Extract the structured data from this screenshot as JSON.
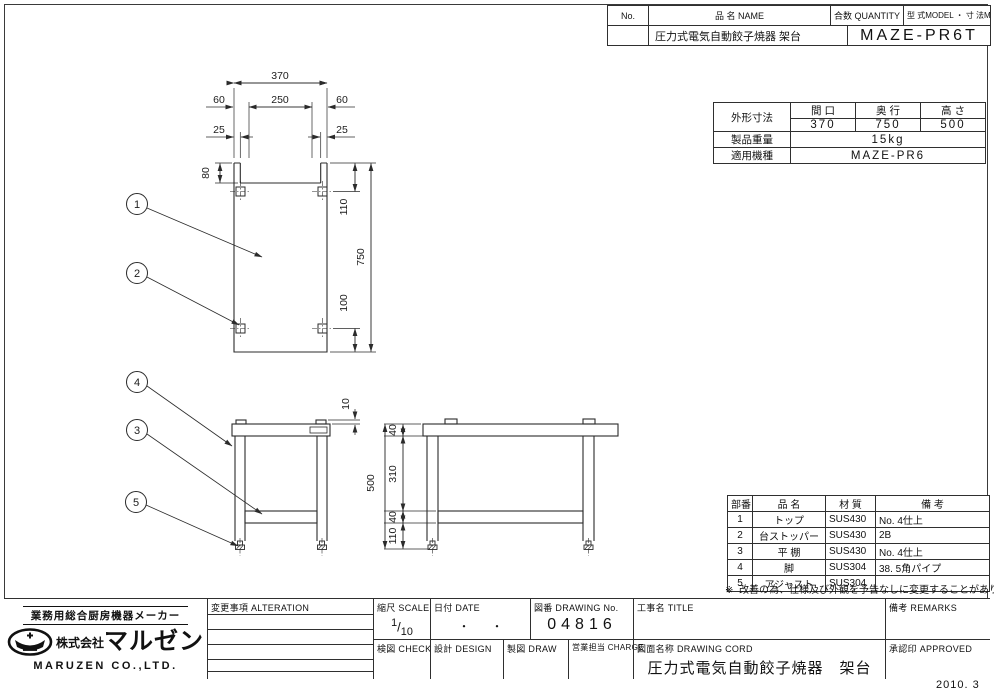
{
  "header_table": {
    "col_no": "No.",
    "col_name": "品  名 NAME",
    "col_qty": "合数 QUANTITY",
    "col_model": "型 式MODEL ・ 寸 法MEASUR",
    "name_value": "圧力式電気自動餃子焼器  架台",
    "model_value": "MAZE-PR6T"
  },
  "spec_table": {
    "dim_label": "外形寸法",
    "col_width": "間 口",
    "col_depth": "奥 行",
    "col_height": "高 さ",
    "width": "370",
    "depth": "750",
    "height": "500",
    "weight_label": "製品重量",
    "weight": "15kg",
    "model_label": "適用機種",
    "model": "MAZE-PR6"
  },
  "parts_table": {
    "col_no": "部番",
    "col_name": "品  名",
    "col_material": "材 質",
    "col_remarks": "備  考",
    "rows": [
      {
        "no": "1",
        "name": "トップ",
        "material": "SUS430",
        "remarks": "No. 4仕上"
      },
      {
        "no": "2",
        "name": "台ストッパー",
        "material": "SUS430",
        "remarks": "2B"
      },
      {
        "no": "3",
        "name": "平 棚",
        "material": "SUS430",
        "remarks": "No. 4仕上"
      },
      {
        "no": "4",
        "name": "脚",
        "material": "SUS304",
        "remarks": "38. 5角パイプ"
      },
      {
        "no": "5",
        "name": "アジャスト",
        "material": "SUS304",
        "remarks": ""
      }
    ]
  },
  "note": {
    "mark": "※",
    "text": "改善の為、仕様及び外観を予告なしに変更することがあります。"
  },
  "title_block": {
    "alteration_label": "変更事項 ALTERATION",
    "scale_label": "縮尺 SCALE",
    "scale_num": "1",
    "scale_slash": "/",
    "scale_den": "10",
    "date_label": "日付 DATE",
    "date_value": "・　　・",
    "dwg_no_label": "図番 DRAWING  No.",
    "dwg_no": "04816",
    "title_label": "工事名 TITLE",
    "remarks_label": "備考 REMARKS",
    "check_label": "検図 CHECK",
    "design_label": "設計 DESIGN",
    "draw_label": "製図 DRAW",
    "charge_label": "営業担当 CHARGE",
    "cord_label": "図面名称 DRAWING  CORD",
    "cord_value": "圧力式電気自動餃子焼器　架台",
    "approved_label": "承認印 APPROVED"
  },
  "company": {
    "tagline": "業務用総合厨房機器メーカー",
    "prefix": "株式会社",
    "brand": "マルゼン",
    "name_en": "MARUZEN  CO.,LTD."
  },
  "footer": {
    "date": "2010. 3"
  },
  "drawing": {
    "dims": {
      "overall_width": "370",
      "inner": "250",
      "offset_left": "60",
      "offset_right": "60",
      "tab_left": "25",
      "tab_right": "25",
      "step": "80",
      "top_to_stopper": "110",
      "overall_depth": "750",
      "bottom_to_stopper": "100",
      "tab_height": "10",
      "overall_height": "500",
      "top_thickness": "40",
      "leg_clear": "310",
      "shelf_thickness": "40",
      "shelf_height": "110"
    },
    "balloons": [
      "1",
      "2",
      "3",
      "4",
      "5"
    ]
  }
}
